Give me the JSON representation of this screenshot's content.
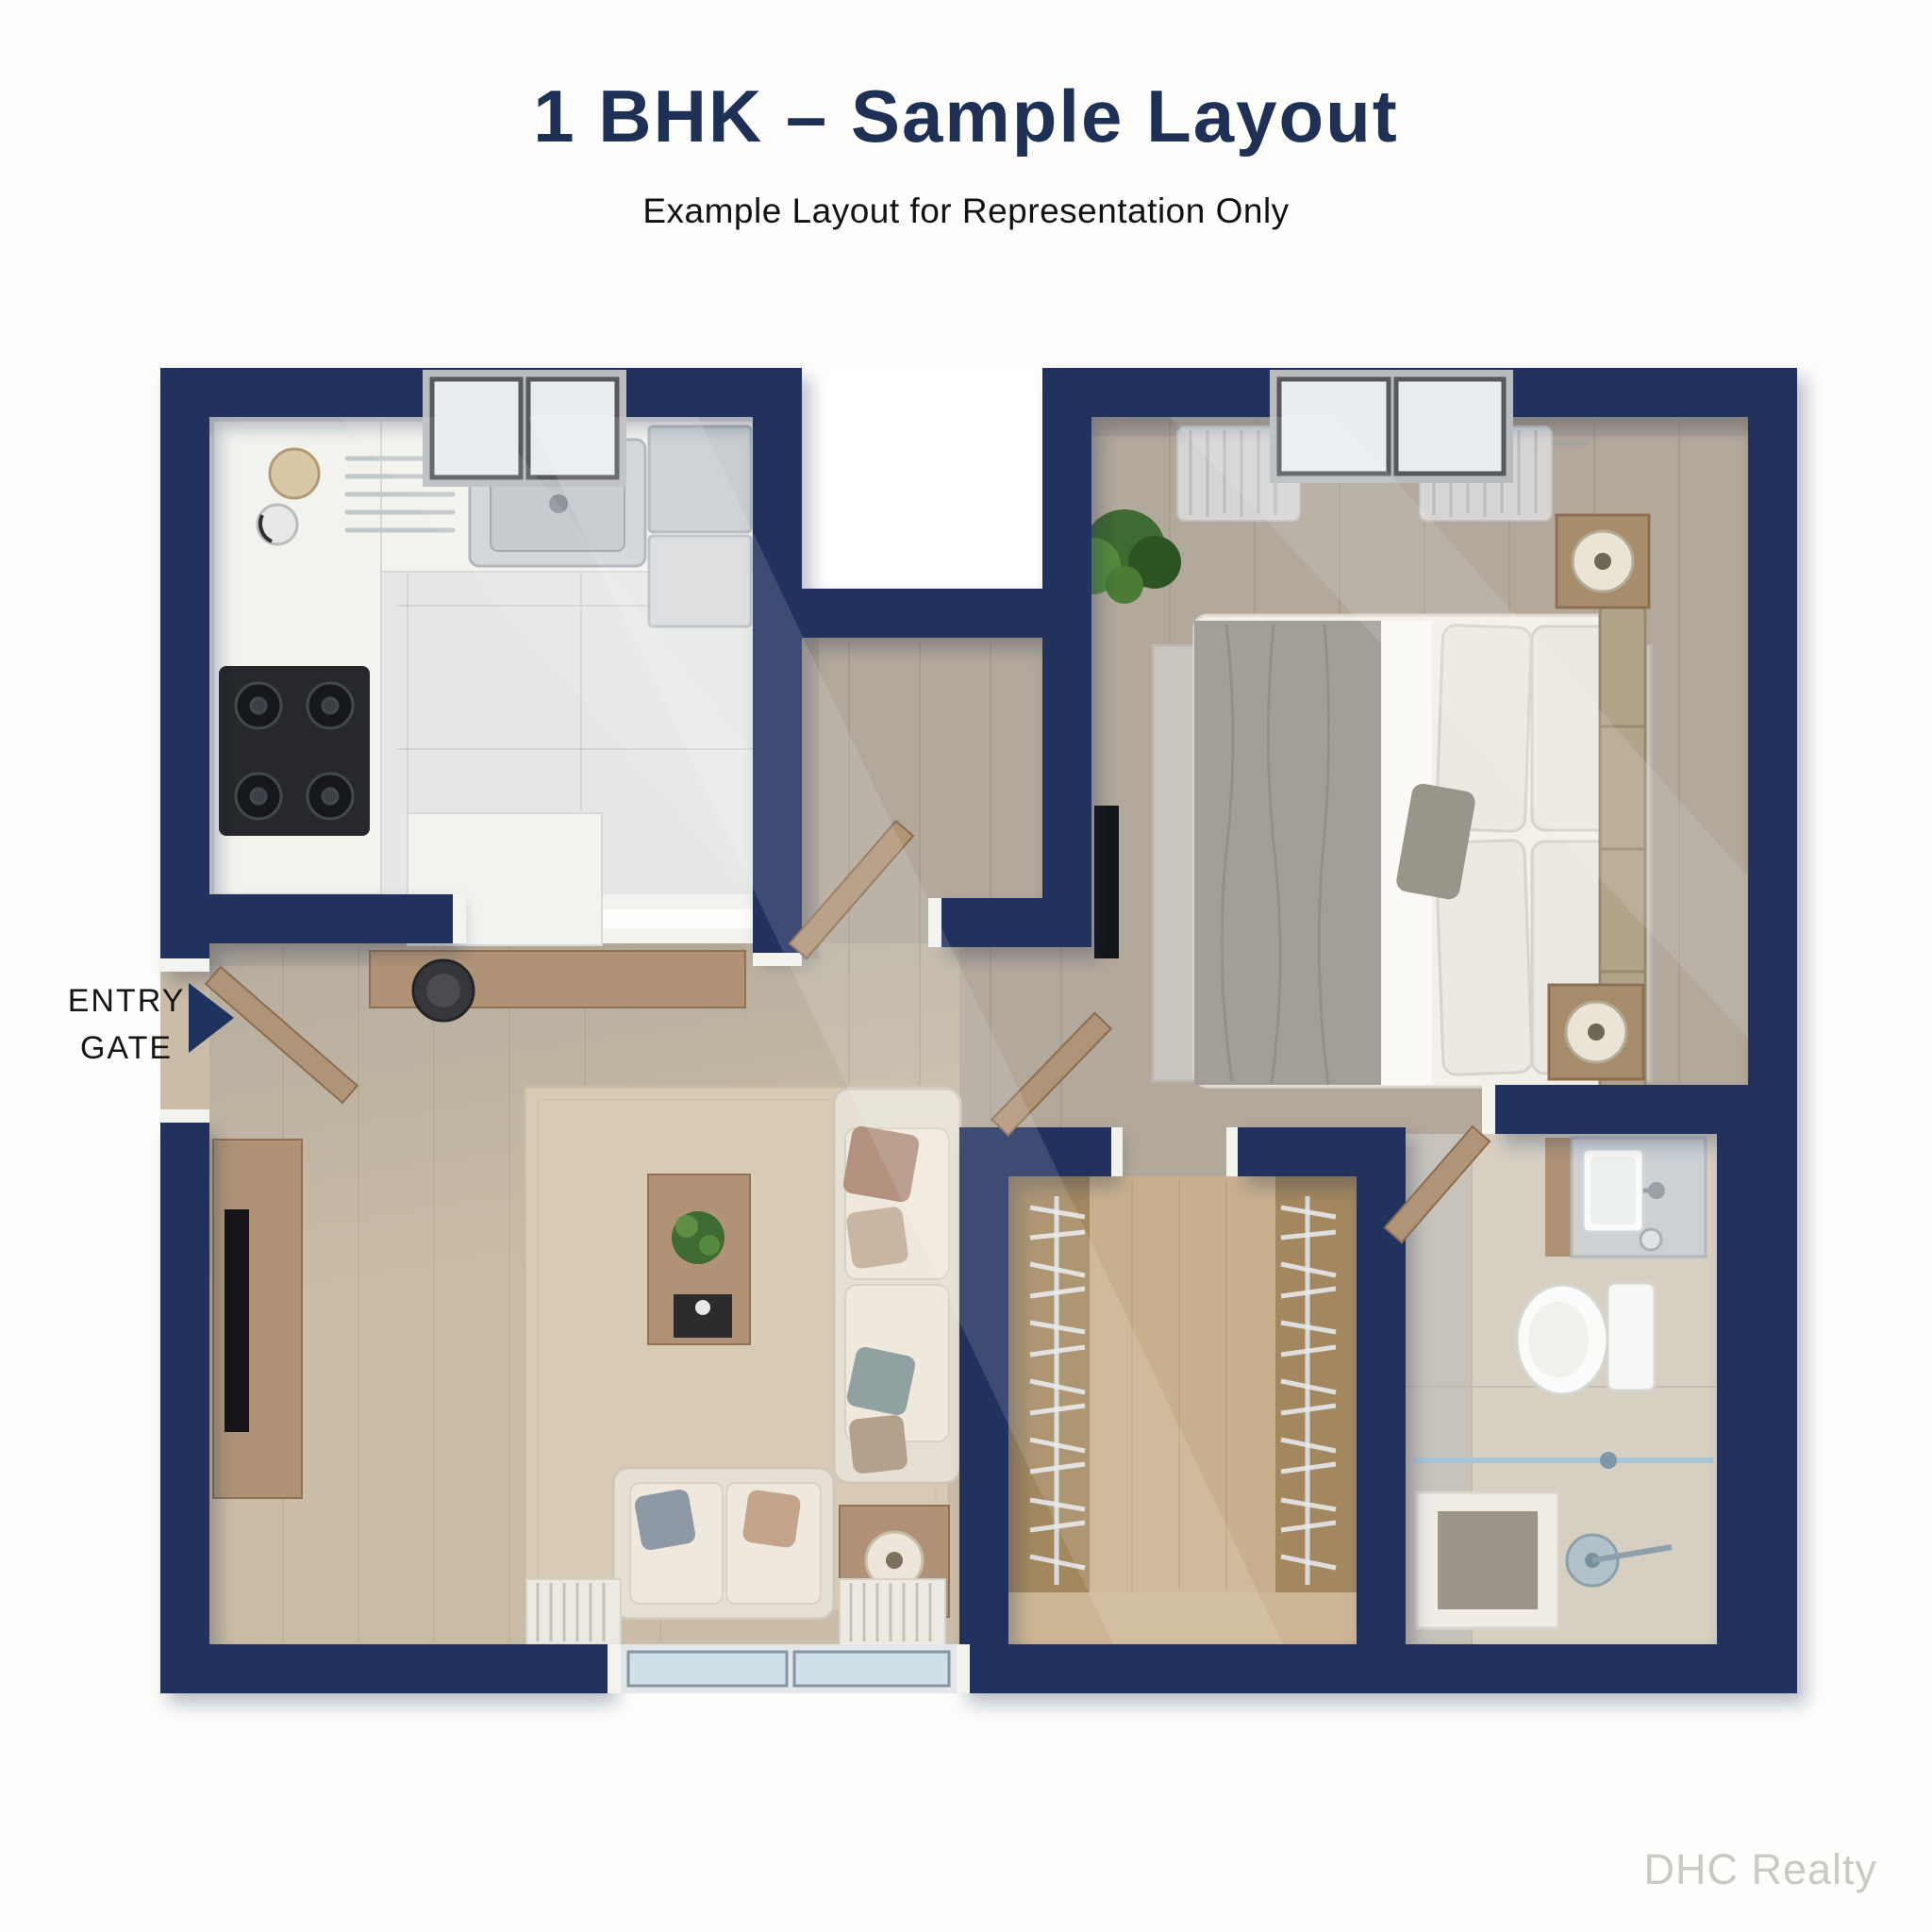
{
  "header": {
    "title": "1 BHK – Sample Layout",
    "subtitle": "Example Layout for Representation Only"
  },
  "entry_label": {
    "line1": "ENTRY",
    "line2": "GATE"
  },
  "watermark": "DHC Realty",
  "plan": {
    "type": "apartment-floor-plan",
    "rooms": [
      "kitchen",
      "entrance-foyer",
      "living-room",
      "bedroom",
      "walk-in-wardrobe",
      "bathroom"
    ]
  },
  "colors": {
    "bg": "#fdfdfb",
    "wall": "#20335e",
    "wall-lining": "#f2f2ef",
    "title": "#1e3056",
    "subtitle-text": "#111113",
    "label-text": "#151515",
    "watermark": "#c9c9c6",
    "floor-tile": "#e6e8e8",
    "floor-living": "#cabca6",
    "floor-gray": "#b2a89b",
    "floor-closet": "#c8b08e",
    "closet-panel": "#a2875f",
    "floor-bath": "#d6cfc2",
    "bath-strip": "#c8c3ba",
    "counter": "#f2f2ef",
    "wood": "#b09376",
    "wood-edge": "#8f7254",
    "sofa": "#e6e0d4",
    "cushion": "#efe9dd",
    "rug-living": "#d8cbb5",
    "rug-bedroom": "#c9c5bf",
    "mattress": "#f3f0e9",
    "blanket": "#a39f98",
    "pillow": "#ebe9e1",
    "headboard": "#b4a38b",
    "tv-dark": "#141518",
    "stove": "#26282c",
    "steel": "#d0d4d7",
    "fridge": "#c8cdd1",
    "glass": "#cfe0e8",
    "glass-frame": "#8795a0",
    "window-pane": "#e9edf0",
    "window-frame": "#b9bcbe",
    "mullion": "#55585c",
    "curtain": "#d8d8d8",
    "door-wood": "#b09478",
    "plant": "#3f6a31",
    "fixture": "#fbfbf9",
    "rail": "#d7dadc"
  }
}
